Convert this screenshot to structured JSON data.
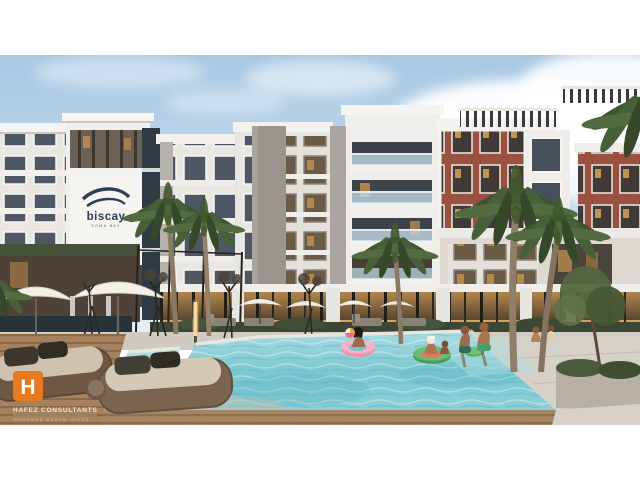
{
  "image": {
    "kind": "architectural-exterior-render",
    "building_logo": {
      "brand": "biscay",
      "tagline": "SOMA BAY"
    },
    "watermark": {
      "monogram": "H",
      "title": "HAFEZ CONSULTANTS",
      "subtitle": "MOHAMED ESSAM HAFEZ"
    },
    "palette": {
      "sky": "#aac9e3",
      "cloud": "#ffffff",
      "facade_white": "#f1efeb",
      "facade_gray": "#9a968f",
      "brick": "#9b5140",
      "window_glass": "#4e5763",
      "warm_light": "#c6934f",
      "pool_water": "#7cc7d1",
      "deck_wood": "#a5825d",
      "palm_green": "#47603a",
      "accent_orange": "#e8791e",
      "logo_navy": "#2c3e53"
    }
  }
}
